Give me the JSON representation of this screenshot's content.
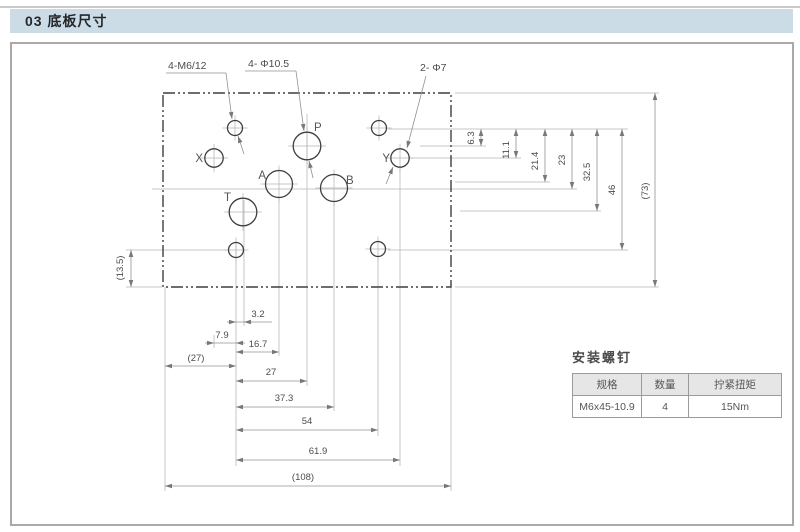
{
  "page": {
    "header": "03 底板尺寸"
  },
  "drawing": {
    "outline": {
      "x": 163,
      "y": 93,
      "w": 288,
      "h": 194
    },
    "holes": [
      {
        "name": "mount-hole-top-left",
        "x": 235,
        "y": 128,
        "r": 7.5
      },
      {
        "name": "mount-hole-top-right",
        "x": 379,
        "y": 128,
        "r": 7.5
      },
      {
        "name": "mount-hole-bottom-left",
        "x": 236,
        "y": 250,
        "r": 7.5
      },
      {
        "name": "mount-hole-bottom-right",
        "x": 378,
        "y": 249,
        "r": 7.5
      },
      {
        "name": "port-X",
        "x": 214,
        "y": 158,
        "r": 9.2
      },
      {
        "name": "port-Y",
        "x": 400,
        "y": 158,
        "r": 9.2
      },
      {
        "name": "port-P",
        "x": 307,
        "y": 146,
        "r": 13.8
      },
      {
        "name": "port-T",
        "x": 243,
        "y": 212,
        "r": 13.8
      },
      {
        "name": "port-A",
        "x": 279,
        "y": 184,
        "r": 13.5
      },
      {
        "name": "port-B",
        "x": 334,
        "y": 188,
        "r": 13.5
      }
    ],
    "port_labels": [
      {
        "t": "X",
        "x": 203,
        "y": 162,
        "anchor": "end"
      },
      {
        "t": "Y",
        "x": 390,
        "y": 162,
        "anchor": "end"
      },
      {
        "t": "P",
        "x": 314,
        "y": 131,
        "anchor": "start"
      },
      {
        "t": "T",
        "x": 231,
        "y": 201,
        "anchor": "end"
      },
      {
        "t": "A",
        "x": 266,
        "y": 179,
        "anchor": "end"
      },
      {
        "t": "B",
        "x": 346,
        "y": 184,
        "anchor": "start"
      }
    ],
    "callouts": [
      {
        "text": "4-M6/12",
        "tx": 168,
        "ty": 69,
        "underline": [
          166,
          226,
          73
        ],
        "segs": [
          [
            226,
            73,
            232,
            119,
            "end"
          ],
          [
            238,
            136,
            244,
            154,
            "start"
          ]
        ]
      },
      {
        "text": "4- Φ10.5",
        "tx": 248,
        "ty": 67,
        "underline": [
          245,
          296,
          71
        ],
        "segs": [
          [
            296,
            71,
            304,
            131,
            "end"
          ],
          [
            309,
            161,
            313,
            178,
            "start"
          ]
        ]
      },
      {
        "text": "2- Φ7",
        "tx": 420,
        "ty": 71,
        "underline": null,
        "segs": [
          [
            426,
            76,
            407,
            148,
            "end"
          ],
          [
            393,
            167,
            386,
            184,
            "start"
          ]
        ]
      }
    ],
    "ext_lines": [
      [
        388,
        129,
        628,
        129
      ],
      [
        455,
        93,
        659,
        93
      ],
      [
        420,
        146,
        486,
        146
      ],
      [
        410,
        158,
        521,
        158
      ],
      [
        455,
        182,
        550,
        182
      ],
      [
        152,
        189,
        577,
        189
      ],
      [
        460,
        211,
        601,
        211
      ],
      [
        388,
        250,
        628,
        250
      ],
      [
        455,
        287,
        659,
        287
      ],
      [
        126,
        250,
        227,
        250
      ],
      [
        126,
        287,
        162,
        287
      ],
      [
        236,
        241,
        236,
        466
      ],
      [
        244,
        200,
        244,
        326
      ],
      [
        279,
        198,
        279,
        356
      ],
      [
        307,
        114,
        307,
        386
      ],
      [
        334,
        202,
        334,
        411
      ],
      [
        378,
        258,
        378,
        436
      ],
      [
        400,
        168,
        400,
        466
      ],
      [
        165,
        287,
        165,
        491
      ],
      [
        451,
        287,
        451,
        491
      ],
      [
        214,
        335,
        214,
        348
      ]
    ],
    "v_dims": [
      {
        "x": 481,
        "y1": 129,
        "y2": 146,
        "label": "6.3",
        "tx": 474,
        "ty": 138
      },
      {
        "x": 516,
        "y1": 129,
        "y2": 158,
        "label": "11.1",
        "tx": 509,
        "ty": 150
      },
      {
        "x": 545,
        "y1": 129,
        "y2": 182,
        "label": "21.4",
        "tx": 538,
        "ty": 161
      },
      {
        "x": 572,
        "y1": 129,
        "y2": 189,
        "label": "23",
        "tx": 565,
        "ty": 160
      },
      {
        "x": 597,
        "y1": 129,
        "y2": 211,
        "label": "32.5",
        "tx": 590,
        "ty": 172
      },
      {
        "x": 622,
        "y1": 129,
        "y2": 250,
        "label": "46",
        "tx": 615,
        "ty": 190
      },
      {
        "x": 655,
        "y1": 93,
        "y2": 287,
        "label": "(73)",
        "tx": 648,
        "ty": 191
      },
      {
        "x": 131,
        "y1": 250,
        "y2": 287,
        "label": "(13.5)",
        "tx": 123,
        "ty": 268
      }
    ],
    "h_dims": [
      {
        "y": 322,
        "from": 236,
        "to": 244,
        "label": "3.2",
        "tx": 258,
        "ty": 317,
        "arrows": "out",
        "tail": 28
      },
      {
        "y": 343,
        "from": 214,
        "to": 236,
        "label": "7.9",
        "tx": 222,
        "ty": 338,
        "arrows": "out",
        "tail": 0
      },
      {
        "y": 352,
        "from": 236,
        "to": 279,
        "label": "16.7",
        "tx": 258,
        "ty": 347,
        "arrows": "in"
      },
      {
        "y": 366,
        "from": 165,
        "to": 236,
        "label": "(27)",
        "tx": 196,
        "ty": 361,
        "arrows": "in"
      },
      {
        "y": 381,
        "from": 236,
        "to": 307,
        "label": "27",
        "tx": 271,
        "ty": 375,
        "arrows": "in"
      },
      {
        "y": 407,
        "from": 236,
        "to": 334,
        "label": "37.3",
        "tx": 284,
        "ty": 401,
        "arrows": "in"
      },
      {
        "y": 430,
        "from": 236,
        "to": 378,
        "label": "54",
        "tx": 307,
        "ty": 424,
        "arrows": "in"
      },
      {
        "y": 460,
        "from": 236,
        "to": 400,
        "label": "61.9",
        "tx": 318,
        "ty": 454,
        "arrows": "in"
      },
      {
        "y": 486,
        "from": 165,
        "to": 451,
        "label": "(108)",
        "tx": 303,
        "ty": 480,
        "arrows": "in"
      }
    ]
  },
  "screw_table": {
    "title": "安装螺钉",
    "headers": [
      "规格",
      "数量",
      "拧紧扭矩"
    ],
    "rows": [
      [
        "M6x45-10.9",
        "4",
        "15Nm"
      ]
    ]
  }
}
